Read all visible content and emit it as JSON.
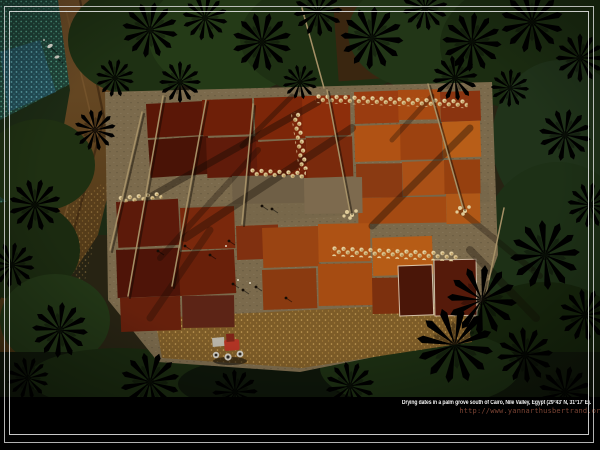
{
  "wallpaper": {
    "caption": "Drying dates in a palm grove south of Cairo, Nile Valley, Egypt (29°43' N, 31°17' E).",
    "credit_url": "http://www.yannarthusbertrand.org"
  },
  "palette": {
    "background": "#000000",
    "frame_line": "#e4e4e4",
    "caption_text": "#f2f2f2",
    "credit_text": "#7c4434",
    "palm_green_dark": "#1e3013",
    "palm_green_bright": "#52803a",
    "date_maroon": "#5a1708",
    "date_red": "#8d2e0b",
    "date_orange": "#b85e18",
    "sack_cream": "#e6d2a2",
    "road_brown": "#6a4a26",
    "field_teal": "#4e9a82",
    "stubble_gold": "#8a6a30",
    "tractor_red": "#b03424"
  }
}
